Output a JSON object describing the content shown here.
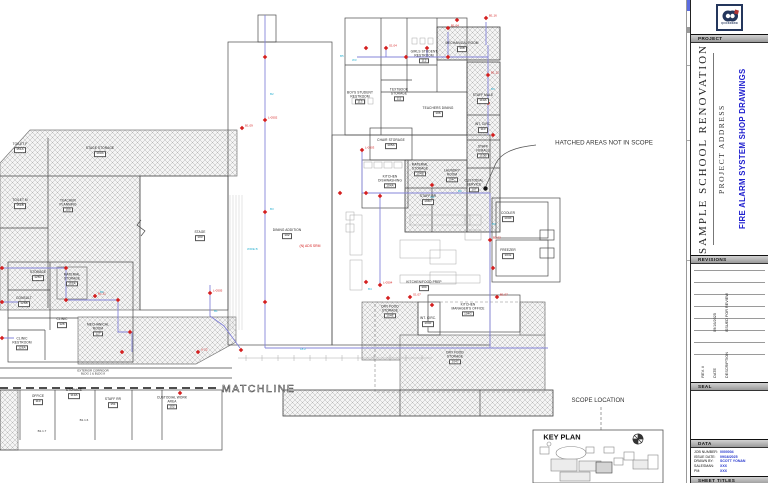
{
  "title_block": {
    "logo_text": "QUICKDRAW",
    "bars": {
      "project": "PROJECT",
      "revisions": "REVISIONS",
      "seal": "SEAL",
      "data": "DATA",
      "sheet_titles": "SHEET TITLES"
    },
    "project": {
      "name": "SAMPLE SCHOOL RENOVATION",
      "address": "PROJECT ADDRESS",
      "drawing_title": "FIRE ALARM SYSTEM SHOP DRAWINGS"
    },
    "revisions": {
      "headers": {
        "rev": "REV. #",
        "date": "DATE",
        "description": "DESCRIPTION"
      },
      "entries": [
        {
          "rev": "",
          "date": "09/16/2025",
          "description": "ISSUED FOR REVIEW"
        }
      ]
    },
    "data": {
      "rows": [
        {
          "label": "JOB NUMBER:",
          "value": "0000004"
        },
        {
          "label": "ISSUE DATE:",
          "value": "09/16/2025"
        },
        {
          "label": "DRAWN BY:",
          "value": "SCOTT YONAN"
        },
        {
          "label": "SALESMAN:",
          "value": "XXX"
        },
        {
          "label": "PM:",
          "value": "XXX"
        }
      ]
    }
  },
  "plan": {
    "notes": {
      "hatched": "HATCHED AREAS NOT IN SCOPE",
      "matchline": "MATCHLINE",
      "scope_location": "SCOPE LOCATION",
      "key_plan": "KEY PLAN",
      "corridor_l1": "EXTERIOR CORRIDOR",
      "corridor_l2": "BLDG 1 & BLDG 8",
      "srm": "(N) ADS SRM",
      "ref_a": "B1.1.6",
      "ref_b": "B1.1.7"
    },
    "rooms": [
      {
        "n": "BOYS STUDENT RESTROOM",
        "r": "113",
        "x": 360,
        "y": 98,
        "w": 30
      },
      {
        "n": "GIRLS STUDENT RESTROOM",
        "r": "112",
        "x": 424,
        "y": 57,
        "w": 30
      },
      {
        "n": "MECHANICAL ROOM",
        "r": "108",
        "x": 462,
        "y": 47,
        "w": 34
      },
      {
        "n": "TEACHERS DINING",
        "r": "106",
        "x": 438,
        "y": 112,
        "w": 32
      },
      {
        "n": "TEXTBOOK STORAGE",
        "r": "111",
        "x": 399,
        "y": 95,
        "w": 30
      },
      {
        "n": "CHAIR STORAGE",
        "r": "105A",
        "x": 391,
        "y": 144,
        "w": 28
      },
      {
        "n": "STAFF MALE",
        "r": "110A",
        "x": 483,
        "y": 99,
        "w": 24
      },
      {
        "n": "INT. CIRC.",
        "r": "110",
        "x": 483,
        "y": 128,
        "w": 24
      },
      {
        "n": "STAFF FEMALE",
        "r": "110B",
        "x": 483,
        "y": 152,
        "w": 24
      },
      {
        "n": "KITCHEN DISHWASHING",
        "r": "104A",
        "x": 390,
        "y": 182,
        "w": 34
      },
      {
        "n": "MATERIAL STORAGE",
        "r": "104B",
        "x": 420,
        "y": 170,
        "w": 26
      },
      {
        "n": "LAUNDRY ROOM",
        "r": "104C",
        "x": 452,
        "y": 176,
        "w": 26
      },
      {
        "n": "STAFF RR",
        "r": "104D",
        "x": 428,
        "y": 200,
        "w": 22
      },
      {
        "n": "CUSTODIAL SERVICE",
        "r": "107",
        "x": 474,
        "y": 186,
        "w": 26
      },
      {
        "n": "KITCHEN/FOOD PREP",
        "r": "104",
        "x": 424,
        "y": 286,
        "w": 44
      },
      {
        "n": "DRY FOOD STORAGE",
        "r": "104E",
        "x": 390,
        "y": 312,
        "w": 28
      },
      {
        "n": "INT. CIRC.",
        "r": "104F",
        "x": 428,
        "y": 322,
        "w": 22
      },
      {
        "n": "KITCHEN MANAGER'S OFFICE",
        "r": "104G",
        "x": 468,
        "y": 310,
        "w": 34
      },
      {
        "n": "DRY FOOD STORAGE",
        "r": "104J",
        "x": 455,
        "y": 358,
        "w": 30
      },
      {
        "n": "COOLER",
        "r": "104K",
        "x": 508,
        "y": 217,
        "w": 26
      },
      {
        "n": "FREEZER",
        "r": "104L",
        "x": 508,
        "y": 254,
        "w": 26
      },
      {
        "n": "DINING ADDITION",
        "r": "102",
        "x": 287,
        "y": 234,
        "w": 30
      },
      {
        "n": "STAGE",
        "r": "103",
        "x": 200,
        "y": 236,
        "w": 24
      },
      {
        "n": "STAGE STORAGE",
        "r": "103A",
        "x": 100,
        "y": 152,
        "w": 30
      },
      {
        "n": "TOILET F",
        "r": "151A",
        "x": 20,
        "y": 148,
        "w": 22
      },
      {
        "n": "TOILET M",
        "r": "151B",
        "x": 20,
        "y": 204,
        "w": 22
      },
      {
        "n": "TEACHER PLANNING",
        "r": "150",
        "x": 68,
        "y": 206,
        "w": 30
      },
      {
        "n": "STORAGE",
        "r": "126C",
        "x": 38,
        "y": 276,
        "w": 24
      },
      {
        "n": "MATERIAL STORAGE",
        "r": "155A",
        "x": 72,
        "y": 280,
        "w": 26
      },
      {
        "n": "CONSULT",
        "r": "126B",
        "x": 24,
        "y": 302,
        "w": 24
      },
      {
        "n": "CLINIC",
        "r": "126",
        "x": 62,
        "y": 323,
        "w": 22
      },
      {
        "n": "CLINIC RESTROOM",
        "r": "126A",
        "x": 22,
        "y": 344,
        "w": 26
      },
      {
        "n": "MECHANICAL ROOM",
        "r": "127",
        "x": 98,
        "y": 330,
        "w": 30
      },
      {
        "n": "OFFICE",
        "r": "110",
        "x": 38,
        "y": 400,
        "w": 22
      },
      {
        "n": "STORAGE",
        "r": "113A",
        "x": 74,
        "y": 394,
        "w": 24
      },
      {
        "n": "STAFF RR",
        "r": "151",
        "x": 113,
        "y": 403,
        "w": 22
      },
      {
        "n": "CUSTODIAL WORK AREA",
        "r": "152",
        "x": 172,
        "y": 403,
        "w": 32
      }
    ],
    "devices": [
      {
        "x": 265,
        "y": 57
      },
      {
        "x": 265,
        "y": 120,
        "l": "L-0502"
      },
      {
        "x": 265,
        "y": 212
      },
      {
        "x": 265,
        "y": 302
      },
      {
        "x": 242,
        "y": 128,
        "l": "B1.09"
      },
      {
        "x": 366,
        "y": 48
      },
      {
        "x": 386,
        "y": 48,
        "l": "S1.04"
      },
      {
        "x": 406,
        "y": 57
      },
      {
        "x": 427,
        "y": 48
      },
      {
        "x": 448,
        "y": 28,
        "l": "B1.04"
      },
      {
        "x": 457,
        "y": 20
      },
      {
        "x": 486,
        "y": 18,
        "l": "B1.16"
      },
      {
        "x": 488,
        "y": 75,
        "l": "B1.12"
      },
      {
        "x": 488,
        "y": 103
      },
      {
        "x": 493,
        "y": 135
      },
      {
        "x": 362,
        "y": 150,
        "l": "L-0503"
      },
      {
        "x": 340,
        "y": 193
      },
      {
        "x": 366,
        "y": 193
      },
      {
        "x": 380,
        "y": 196
      },
      {
        "x": 432,
        "y": 185
      },
      {
        "x": 380,
        "y": 285,
        "l": "L-0504"
      },
      {
        "x": 366,
        "y": 282
      },
      {
        "x": 388,
        "y": 298
      },
      {
        "x": 410,
        "y": 297,
        "l": "S1.07"
      },
      {
        "x": 432,
        "y": 305
      },
      {
        "x": 490,
        "y": 240,
        "l": "B2.02"
      },
      {
        "x": 493,
        "y": 268
      },
      {
        "x": 497,
        "y": 297,
        "l": "B1.07"
      },
      {
        "x": 210,
        "y": 293,
        "l": "L-0505"
      },
      {
        "x": 241,
        "y": 350
      },
      {
        "x": 198,
        "y": 352,
        "l": "U-22"
      },
      {
        "x": 66,
        "y": 268
      },
      {
        "x": 95,
        "y": 296,
        "l": "B1.21"
      },
      {
        "x": 66,
        "y": 300
      },
      {
        "x": 118,
        "y": 300
      },
      {
        "x": 130,
        "y": 332
      },
      {
        "x": 122,
        "y": 352
      },
      {
        "x": 2,
        "y": 268
      },
      {
        "x": 2,
        "y": 302
      },
      {
        "x": 2,
        "y": 338
      },
      {
        "x": 180,
        "y": 393
      },
      {
        "x": 448,
        "y": 57
      }
    ],
    "wire_labels": [
      {
        "x": 270,
        "y": 95,
        "t": "B2"
      },
      {
        "x": 270,
        "y": 210,
        "t": "B3"
      },
      {
        "x": 352,
        "y": 61,
        "t": "W3"
      },
      {
        "x": 458,
        "y": 192,
        "t": "B2"
      },
      {
        "x": 492,
        "y": 225,
        "t": "B3"
      },
      {
        "x": 430,
        "y": 198,
        "t": "W2"
      },
      {
        "x": 300,
        "y": 350,
        "t": "18.2"
      },
      {
        "x": 368,
        "y": 290,
        "t": "B4"
      },
      {
        "x": 100,
        "y": 293,
        "t": "B6"
      },
      {
        "x": 214,
        "y": 312,
        "t": "B1"
      },
      {
        "x": 491,
        "y": 90,
        "t": "B3"
      },
      {
        "x": 247,
        "y": 250,
        "t": "WIRE B"
      },
      {
        "x": 340,
        "y": 57,
        "t": "B5"
      }
    ]
  }
}
